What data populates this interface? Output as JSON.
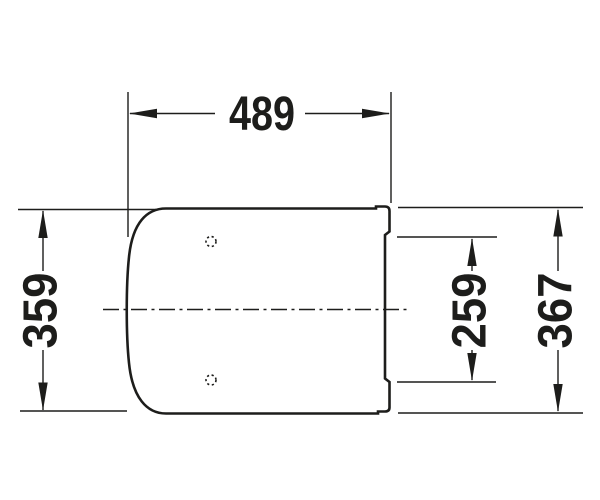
{
  "page": {
    "background_color": "#ffffff",
    "line_color": "#1d1d1b"
  },
  "drawing": {
    "kind": "dimension-drawing",
    "dimensions": {
      "top_width": {
        "label": "489",
        "value": 489
      },
      "left_height": {
        "label": "359",
        "value": 359
      },
      "right_inner_height": {
        "label": "259",
        "value": 259
      },
      "right_outer_height": {
        "label": "367",
        "value": 367
      }
    }
  }
}
